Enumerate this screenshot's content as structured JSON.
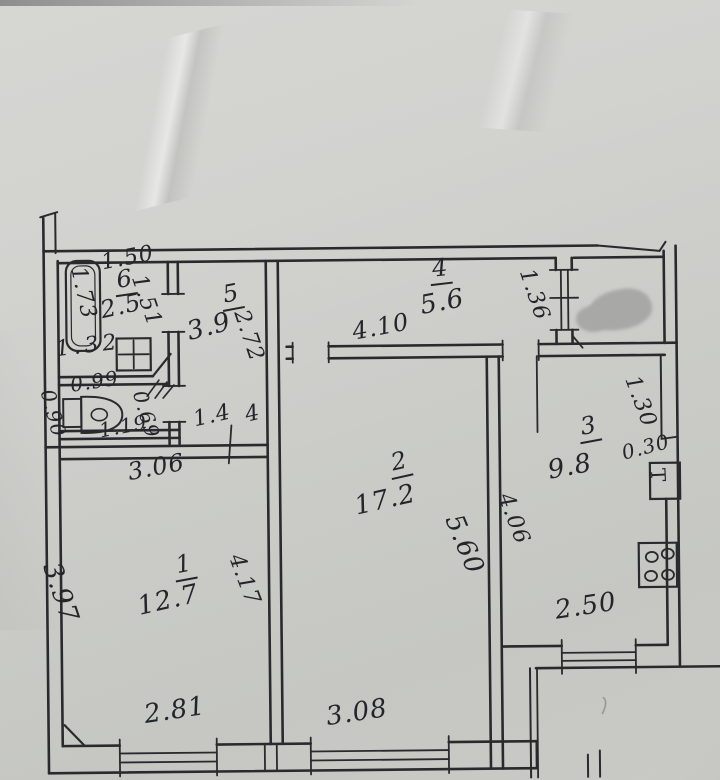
{
  "plan": {
    "room1": {
      "number": "1",
      "area": "12.7",
      "dim_top": "3.06",
      "dim_left": "3.97",
      "dim_right": "4.17",
      "dim_window": "2.81"
    },
    "room2": {
      "number": "2",
      "area": "17.2",
      "dim_right": "5.60",
      "dim_window": "3.08"
    },
    "room3": {
      "number": "3",
      "area": "9.8",
      "dim_left": "4.06",
      "dim_recess": "1.30",
      "dim_vent": "0.30",
      "dim_window": "2.50",
      "vent_label": "Т"
    },
    "room4_hall": {
      "number": "4",
      "area": "5.6",
      "dim_bottom": "4.10",
      "dim_door": "1.36"
    },
    "room5_hall": {
      "number": "5",
      "area": "3.9",
      "dim_right": "2.72",
      "dim_bottom_a": "1.4",
      "dim_bottom_b": "4"
    },
    "room6_bath": {
      "number": "6",
      "area": "2.5",
      "dim_top": "1.50",
      "dim_right": "1.51",
      "dim_tub": "1.73",
      "dim_bottom": "1.32"
    },
    "wc": {
      "dim_top": "0.99",
      "dim_left": "0.90",
      "dim_right": "0.69",
      "dim_bottom": "1.19"
    }
  }
}
